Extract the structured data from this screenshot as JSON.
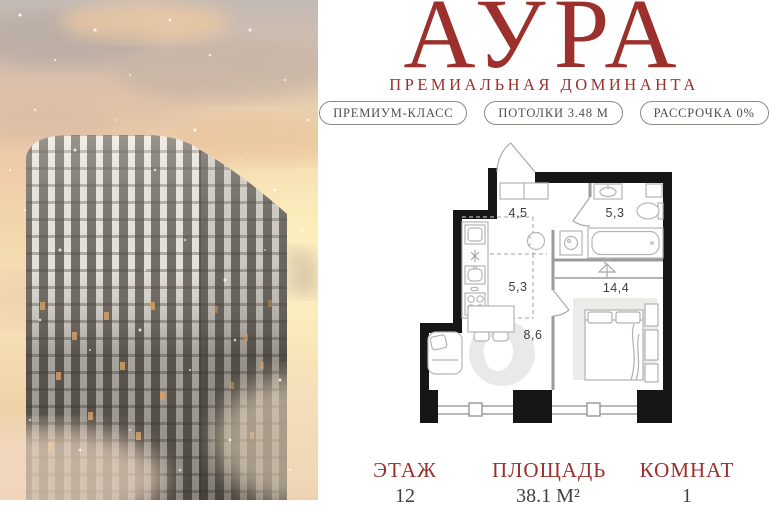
{
  "brand": {
    "title": "АУРА",
    "subtitle": "ПРЕМИАЛЬНАЯ ДОМИНАНТА"
  },
  "badges": [
    {
      "label": "ПРЕМИУМ-КЛАСС"
    },
    {
      "label": "ПОТОЛКИ 3.48 М"
    },
    {
      "label": "РАССРОЧКА 0%"
    }
  ],
  "floorplan": {
    "rooms": [
      {
        "name": "hallway",
        "area": "4,5"
      },
      {
        "name": "bathroom",
        "area": "5,3"
      },
      {
        "name": "kitchen",
        "area": "5,3"
      },
      {
        "name": "living",
        "area": "8,6"
      },
      {
        "name": "bedroom",
        "area": "14,4"
      }
    ]
  },
  "stats": [
    {
      "label": "ЭТАЖ",
      "value": "12"
    },
    {
      "label": "ПЛОЩАДЬ",
      "value": "38.1 М²"
    },
    {
      "label": "КОМНАТ",
      "value": "1"
    }
  ],
  "colors": {
    "brand_red": "#9b302c",
    "badge_text": "#514f4a",
    "plan_wall": "#161616",
    "stat_value": "#404040"
  }
}
